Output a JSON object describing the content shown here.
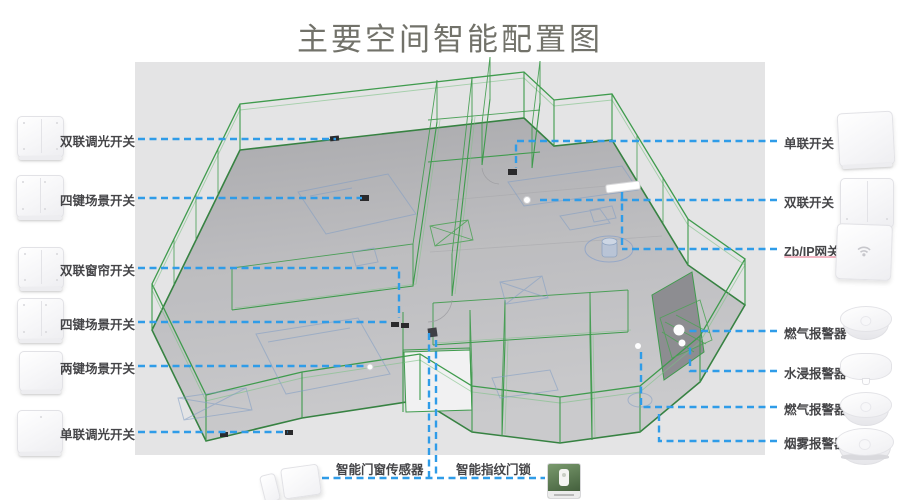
{
  "title": "主要空间智能配置图",
  "left_devices": [
    {
      "label": "双联调光开关",
      "icon": "double-rocker-switch"
    },
    {
      "label": "四键场景开关",
      "icon": "four-key-scene-switch"
    },
    {
      "label": "双联窗帘开关",
      "icon": "double-curtain-switch"
    },
    {
      "label": "四键场景开关",
      "icon": "four-key-scene-switch"
    },
    {
      "label": "两键场景开关",
      "icon": "two-key-scene-switch"
    },
    {
      "label": "单联调光开关",
      "icon": "single-rocker-switch"
    }
  ],
  "right_devices": [
    {
      "label": "单联开关",
      "icon": "single-rocker-switch"
    },
    {
      "label": "双联开关",
      "icon": "double-rocker-switch"
    },
    {
      "label": "Zb/IP网关",
      "icon": "zigbee-ip-gateway"
    },
    {
      "label": "燃气报警器",
      "icon": "gas-alarm"
    },
    {
      "label": "水浸报警器",
      "icon": "water-leak-alarm"
    },
    {
      "label": "燃气报警器",
      "icon": "gas-alarm"
    },
    {
      "label": "烟雾报警器",
      "icon": "smoke-alarm"
    }
  ],
  "bottom_devices": [
    {
      "label": "智能门窗传感器",
      "icon": "door-window-sensor"
    },
    {
      "label": "智能指纹门锁",
      "icon": "fingerprint-door-lock"
    }
  ],
  "colors": {
    "leader_line": "#2f9ce8",
    "wireframe_green": "#3f9b4d",
    "floor_gray": "#b9b9bc",
    "canvas_gray": "#e4e4e5",
    "title_text": "#72726a",
    "label_text": "#454548"
  }
}
